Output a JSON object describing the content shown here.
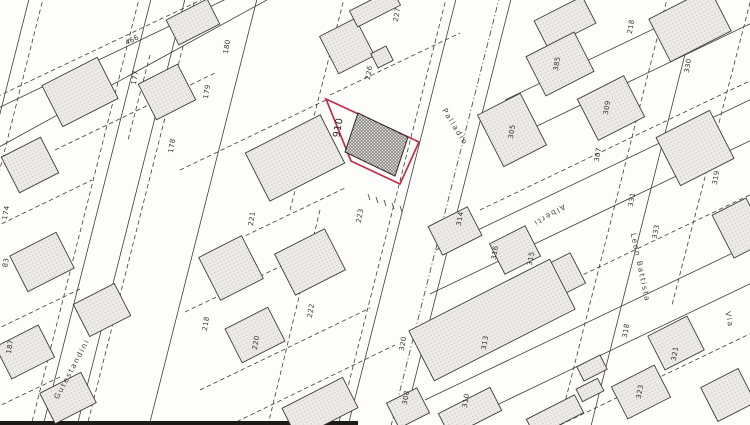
{
  "map": {
    "type": "cadastral-plan-scan",
    "highlight_color": "#c22e4c",
    "highlighted_parcel": {
      "label": "910"
    },
    "parcel_labels": [
      {
        "text": "466",
        "x": 133,
        "y": 42,
        "rot": -27
      },
      {
        "text": "177",
        "x": 137,
        "y": 78,
        "rot": -80
      },
      {
        "text": "180",
        "x": 229,
        "y": 47,
        "rot": -80
      },
      {
        "text": "179",
        "x": 209,
        "y": 92,
        "rot": -80
      },
      {
        "text": "178",
        "x": 174,
        "y": 146,
        "rot": -80
      },
      {
        "text": "174",
        "x": 8,
        "y": 213,
        "rot": -80
      },
      {
        "text": "83",
        "x": 8,
        "y": 263,
        "rot": -80
      },
      {
        "text": "187",
        "x": 12,
        "y": 347,
        "rot": -80
      },
      {
        "text": "227",
        "x": 399,
        "y": 15,
        "rot": -80
      },
      {
        "text": "226",
        "x": 371,
        "y": 73,
        "rot": -80
      },
      {
        "text": "221",
        "x": 254,
        "y": 219,
        "rot": -80
      },
      {
        "text": "223",
        "x": 362,
        "y": 216,
        "rot": -80
      },
      {
        "text": "222",
        "x": 313,
        "y": 311,
        "rot": -80
      },
      {
        "text": "218",
        "x": 208,
        "y": 324,
        "rot": -80
      },
      {
        "text": "220",
        "x": 258,
        "y": 343,
        "rot": -80
      },
      {
        "text": "218",
        "x": 633,
        "y": 27,
        "rot": -80
      },
      {
        "text": "330",
        "x": 690,
        "y": 66,
        "rot": -80
      },
      {
        "text": "385",
        "x": 559,
        "y": 64,
        "rot": -80
      },
      {
        "text": "305",
        "x": 514,
        "y": 132,
        "rot": -80
      },
      {
        "text": "309",
        "x": 609,
        "y": 108,
        "rot": -80
      },
      {
        "text": "307",
        "x": 600,
        "y": 155,
        "rot": -80
      },
      {
        "text": "331",
        "x": 634,
        "y": 200,
        "rot": -80
      },
      {
        "text": "333",
        "x": 658,
        "y": 232,
        "rot": -80
      },
      {
        "text": "319",
        "x": 718,
        "y": 178,
        "rot": -80
      },
      {
        "text": "314",
        "x": 462,
        "y": 219,
        "rot": -80
      },
      {
        "text": "316",
        "x": 497,
        "y": 253,
        "rot": -80
      },
      {
        "text": "315",
        "x": 533,
        "y": 259,
        "rot": -80
      },
      {
        "text": "313",
        "x": 487,
        "y": 343,
        "rot": -80
      },
      {
        "text": "320",
        "x": 405,
        "y": 344,
        "rot": -80
      },
      {
        "text": "308",
        "x": 408,
        "y": 398,
        "rot": -80
      },
      {
        "text": "310",
        "x": 468,
        "y": 401,
        "rot": -80
      },
      {
        "text": "318",
        "x": 628,
        "y": 331,
        "rot": -80
      },
      {
        "text": "321",
        "x": 677,
        "y": 354,
        "rot": -80
      },
      {
        "text": "323",
        "x": 642,
        "y": 392,
        "rot": -80
      }
    ],
    "street_labels": [
      {
        "text": "Palladio",
        "x": 453,
        "y": 128,
        "rot": 58
      },
      {
        "text": "Alberti",
        "x": 548,
        "y": 213,
        "rot": 150
      },
      {
        "text": "Leon Battista",
        "x": 638,
        "y": 268,
        "rot": 78
      },
      {
        "text": "Via",
        "x": 727,
        "y": 320,
        "rot": 78
      },
      {
        "text": "Gutestandini",
        "x": 74,
        "y": 370,
        "rot": -62
      }
    ]
  }
}
